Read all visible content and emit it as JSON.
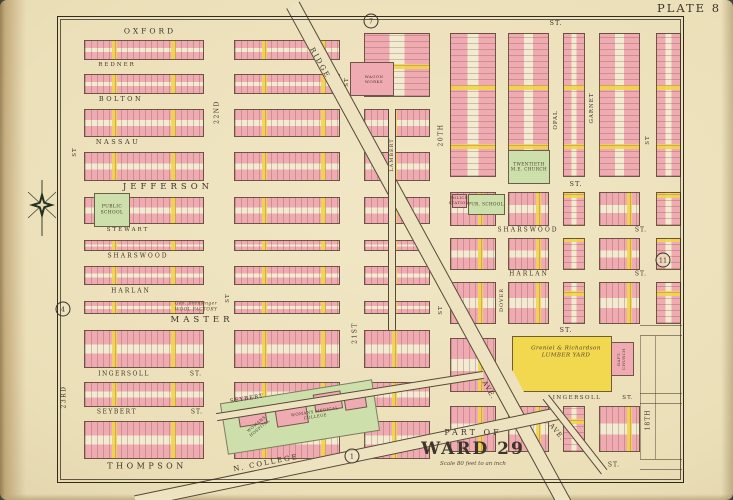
{
  "plate_label": "PLATE 8",
  "title_block": {
    "part_of": "PART OF",
    "ward": "WARD 29",
    "scale": "Scale 80 feet to an inch"
  },
  "palette": {
    "paper": "#ebdfb8",
    "block_pink": "#efabb1",
    "accent_yellow": "#f2d84e",
    "public_green": "#cde0ab",
    "line_brown": "#4a3a2c",
    "frame_black": "#332a1e"
  },
  "street_labels": [
    {
      "id": "street-oxford",
      "text": "OXFORD",
      "x": 150,
      "y": 31,
      "fs": 7.5,
      "ls": 3
    },
    {
      "id": "street-redner",
      "text": "REDNER",
      "x": 117,
      "y": 65,
      "fs": 5.5,
      "ls": 2
    },
    {
      "id": "street-bolton",
      "text": "BOLTON",
      "x": 121,
      "y": 99,
      "fs": 6.5,
      "ls": 2.5
    },
    {
      "id": "street-nassau",
      "text": "NASSAU",
      "x": 118,
      "y": 142,
      "fs": 6.5,
      "ls": 2.5
    },
    {
      "id": "street-jefferson",
      "text": "JEFFERSON",
      "x": 168,
      "y": 187,
      "fs": 8.5,
      "ls": 4
    },
    {
      "id": "street-stewart",
      "text": "STEWART",
      "x": 128,
      "y": 230,
      "fs": 5.5,
      "ls": 2
    },
    {
      "id": "street-sharswood-west",
      "text": "SHARSWOOD",
      "x": 138,
      "y": 256,
      "fs": 6,
      "ls": 2
    },
    {
      "id": "street-harlan-west",
      "text": "HARLAN",
      "x": 131,
      "y": 291,
      "fs": 6,
      "ls": 2
    },
    {
      "id": "street-master",
      "text": "MASTER",
      "x": 202,
      "y": 320,
      "fs": 8.5,
      "ls": 4
    },
    {
      "id": "street-ingersoll-west",
      "text": "INGERSOLL",
      "x": 124,
      "y": 374,
      "fs": 6,
      "ls": 1.5
    },
    {
      "id": "street-ingersoll-west-st",
      "text": "ST.",
      "x": 196,
      "y": 374,
      "fs": 6,
      "ls": 1
    },
    {
      "id": "street-seybert-west",
      "text": "SEYBERT",
      "x": 117,
      "y": 412,
      "fs": 6,
      "ls": 1.5
    },
    {
      "id": "street-seybert-west-st",
      "text": "ST.",
      "x": 197,
      "y": 412,
      "fs": 6,
      "ls": 1
    },
    {
      "id": "street-thompson",
      "text": "THOMPSON",
      "x": 147,
      "y": 466,
      "fs": 8,
      "ls": 3.5
    },
    {
      "id": "street-st-top-right",
      "text": "ST.",
      "x": 556,
      "y": 23,
      "fs": 6.5,
      "ls": 1
    },
    {
      "id": "street-st-jefferson-east",
      "text": "ST.",
      "x": 576,
      "y": 184,
      "fs": 6.5,
      "ls": 1
    },
    {
      "id": "street-sharswood-east",
      "text": "SHARSWOOD",
      "x": 528,
      "y": 230,
      "fs": 6,
      "ls": 2
    },
    {
      "id": "street-sharswood-east-st",
      "text": "ST.",
      "x": 641,
      "y": 230,
      "fs": 6,
      "ls": 1
    },
    {
      "id": "street-harlan-east",
      "text": "HARLAN",
      "x": 529,
      "y": 274,
      "fs": 6,
      "ls": 2
    },
    {
      "id": "street-harlan-east-st",
      "text": "ST.",
      "x": 641,
      "y": 274,
      "fs": 6,
      "ls": 1
    },
    {
      "id": "street-st-master-east",
      "text": "ST.",
      "x": 566,
      "y": 330,
      "fs": 6.5,
      "ls": 1
    },
    {
      "id": "street-ingersoll-east",
      "text": "INGERSOLL",
      "x": 577,
      "y": 398,
      "fs": 5.5,
      "ls": 1.5
    },
    {
      "id": "street-ingersoll-east-st",
      "text": "ST.",
      "x": 628,
      "y": 398,
      "fs": 5.5,
      "ls": 1
    },
    {
      "id": "street-st-bottom-right",
      "text": "ST.",
      "x": 614,
      "y": 465,
      "fs": 6,
      "ls": 1
    },
    {
      "id": "street-23rd",
      "text": "23RD",
      "x": 64,
      "y": 397,
      "rot": -90,
      "fs": 6,
      "ls": 1.5
    },
    {
      "id": "street-23rd-st",
      "text": "ST",
      "x": 75,
      "y": 152,
      "rot": -90,
      "fs": 5.5,
      "ls": 1
    },
    {
      "id": "street-22nd",
      "text": "22ND",
      "x": 217,
      "y": 112,
      "rot": -90,
      "fs": 6,
      "ls": 1.5
    },
    {
      "id": "street-22nd-st",
      "text": "ST",
      "x": 228,
      "y": 298,
      "rot": -90,
      "fs": 5.5,
      "ls": 1
    },
    {
      "id": "street-21st",
      "text": "21ST",
      "x": 355,
      "y": 333,
      "rot": -90,
      "fs": 6,
      "ls": 1.5
    },
    {
      "id": "street-21st-st",
      "text": "ST",
      "x": 347,
      "y": 82,
      "rot": -90,
      "fs": 5.5,
      "ls": 1
    },
    {
      "id": "street-20th",
      "text": "20TH",
      "x": 441,
      "y": 135,
      "rot": -90,
      "fs": 6,
      "ls": 1.5
    },
    {
      "id": "street-20th-st",
      "text": "ST",
      "x": 441,
      "y": 310,
      "rot": -90,
      "fs": 5.5,
      "ls": 1
    },
    {
      "id": "street-dover",
      "text": "DOVER",
      "x": 502,
      "y": 300,
      "rot": -90,
      "fs": 5,
      "ls": 1
    },
    {
      "id": "street-opal",
      "text": "OPAL",
      "x": 556,
      "y": 120,
      "rot": -90,
      "fs": 5.5,
      "ls": 1
    },
    {
      "id": "street-garnet",
      "text": "GARNET",
      "x": 592,
      "y": 108,
      "rot": -90,
      "fs": 5.5,
      "ls": 1
    },
    {
      "id": "street-18th",
      "text": "18TH",
      "x": 648,
      "y": 420,
      "rot": -90,
      "fs": 6,
      "ls": 1
    },
    {
      "id": "street-18th-st",
      "text": "ST",
      "x": 648,
      "y": 140,
      "rot": -90,
      "fs": 5.5,
      "ls": 1
    },
    {
      "id": "street-lambert",
      "text": "LAMBERT",
      "x": 392,
      "y": 155,
      "rot": -90,
      "fs": 5,
      "ls": 1
    },
    {
      "id": "street-ridge",
      "text": "RIDGE",
      "x": 320,
      "y": 63,
      "rot": 61,
      "fs": 7,
      "ls": 2
    },
    {
      "id": "street-ridge-ave-mid",
      "text": "AVE.",
      "x": 489,
      "y": 390,
      "rot": 61,
      "fs": 6.5,
      "ls": 1
    },
    {
      "id": "street-ridge-ave-lower",
      "text": "AVE.",
      "x": 557,
      "y": 432,
      "rot": 50,
      "fs": 6.5,
      "ls": 1
    },
    {
      "id": "street-n-college",
      "text": "N. COLLEGE",
      "x": 266,
      "y": 463,
      "rot": -11,
      "fs": 7,
      "ls": 2
    },
    {
      "id": "street-seybert-diagonal",
      "text": "SEYBERT",
      "x": 247,
      "y": 399,
      "rot": -9,
      "fs": 5.5,
      "ls": 1
    }
  ],
  "landmark_labels": [
    {
      "id": "label-public-school",
      "lines": [
        "PUBLIC",
        "SCHOOL"
      ],
      "x": 112,
      "y": 210,
      "fs": 4.4
    },
    {
      "id": "label-me-church",
      "lines": [
        "TWENTIETH",
        "M.E. CHURCH"
      ],
      "x": 529,
      "y": 167,
      "fs": 4.2
    },
    {
      "id": "label-police-station",
      "lines": [
        "POLICE",
        "STATION"
      ],
      "x": 459,
      "y": 201,
      "fs": 3.8
    },
    {
      "id": "label-pub-school",
      "lines": [
        "PUB. SCHOOL"
      ],
      "x": 486,
      "y": 204,
      "fs": 4.2
    },
    {
      "id": "label-lumber-yard",
      "lines": [
        "Greniel & Richardson",
        "LUMBER YARD"
      ],
      "x": 566,
      "y": 353,
      "fs": 5.6,
      "italic": true
    },
    {
      "id": "label-baptist-church",
      "lines": [
        "BAPT.",
        "CHURCH"
      ],
      "x": 621,
      "y": 359,
      "rot": -90,
      "fs": 4
    },
    {
      "id": "label-womans-medical-college",
      "lines": [
        "WOMANS MEDICAL",
        "COLLEGE"
      ],
      "x": 315,
      "y": 414,
      "rot": -9,
      "fs": 4
    },
    {
      "id": "label-womans-hospital",
      "lines": [
        "WOMANS",
        "HOSPITAL"
      ],
      "x": 258,
      "y": 426,
      "rot": -40,
      "fs": 4
    },
    {
      "id": "label-wagon-works",
      "lines": [
        "WAGON",
        "WORKS"
      ],
      "x": 374,
      "y": 79,
      "fs": 4
    },
    {
      "id": "label-wool-factory",
      "lines": [
        "Geo. Brensinger",
        "WOOL FACTORY"
      ],
      "x": 196,
      "y": 307,
      "fs": 4.4,
      "italic": true
    }
  ],
  "markers": [
    {
      "id": "marker-7",
      "text": "7",
      "x": 371,
      "y": 21
    },
    {
      "id": "marker-11",
      "text": "11",
      "x": 663,
      "y": 260
    },
    {
      "id": "marker-4",
      "text": "4",
      "x": 63,
      "y": 309
    },
    {
      "id": "marker-1",
      "text": "1",
      "x": 352,
      "y": 456
    }
  ],
  "blocks": [
    [
      84,
      40,
      120,
      20,
      "h"
    ],
    [
      84,
      74,
      120,
      20,
      "h"
    ],
    [
      84,
      109,
      120,
      28,
      "h"
    ],
    [
      84,
      152,
      120,
      29,
      "h"
    ],
    [
      84,
      197,
      120,
      27,
      "h"
    ],
    [
      84,
      240,
      120,
      11,
      "h"
    ],
    [
      84,
      266,
      120,
      19,
      "h"
    ],
    [
      84,
      301,
      120,
      13,
      "h"
    ],
    [
      84,
      330,
      120,
      38,
      "h"
    ],
    [
      84,
      382,
      120,
      25,
      "h"
    ],
    [
      84,
      421,
      120,
      38,
      "h"
    ],
    [
      234,
      40,
      106,
      20,
      "h"
    ],
    [
      234,
      74,
      106,
      20,
      "h"
    ],
    [
      234,
      109,
      106,
      28,
      "h"
    ],
    [
      234,
      152,
      106,
      29,
      "h"
    ],
    [
      234,
      197,
      106,
      27,
      "h"
    ],
    [
      234,
      240,
      106,
      11,
      "h"
    ],
    [
      234,
      266,
      106,
      19,
      "h"
    ],
    [
      234,
      301,
      106,
      13,
      "h"
    ],
    [
      234,
      330,
      106,
      38,
      "h"
    ],
    [
      234,
      382,
      106,
      25,
      "h"
    ],
    [
      234,
      421,
      106,
      38,
      "h"
    ],
    [
      364,
      33,
      66,
      64,
      "v"
    ],
    [
      364,
      109,
      66,
      28,
      "h"
    ],
    [
      364,
      152,
      66,
      29,
      "h"
    ],
    [
      364,
      197,
      66,
      27,
      "h"
    ],
    [
      364,
      240,
      66,
      11,
      "h"
    ],
    [
      364,
      266,
      66,
      19,
      "h"
    ],
    [
      364,
      301,
      66,
      13,
      "h"
    ],
    [
      364,
      330,
      66,
      38,
      "h"
    ],
    [
      364,
      382,
      66,
      25,
      "h"
    ],
    [
      364,
      421,
      66,
      38,
      "h"
    ],
    [
      350,
      62,
      44,
      34,
      "p"
    ],
    [
      450,
      33,
      46,
      144,
      "v"
    ],
    [
      450,
      192,
      46,
      34,
      "h"
    ],
    [
      450,
      238,
      46,
      32,
      "h"
    ],
    [
      450,
      282,
      46,
      42,
      "h"
    ],
    [
      450,
      338,
      46,
      54,
      "h"
    ],
    [
      450,
      406,
      46,
      46,
      "h"
    ],
    [
      508,
      33,
      41,
      144,
      "v"
    ],
    [
      508,
      192,
      41,
      34,
      "h"
    ],
    [
      508,
      238,
      41,
      32,
      "h"
    ],
    [
      508,
      282,
      41,
      42,
      "h"
    ],
    [
      508,
      406,
      41,
      46,
      "h"
    ],
    [
      563,
      33,
      22,
      144,
      "v"
    ],
    [
      563,
      192,
      22,
      34,
      "v"
    ],
    [
      563,
      238,
      22,
      32,
      "v"
    ],
    [
      563,
      282,
      22,
      42,
      "v"
    ],
    [
      563,
      406,
      22,
      46,
      "v"
    ],
    [
      599,
      33,
      41,
      144,
      "v"
    ],
    [
      599,
      192,
      41,
      34,
      "h"
    ],
    [
      599,
      238,
      41,
      32,
      "h"
    ],
    [
      599,
      282,
      41,
      42,
      "h"
    ],
    [
      599,
      406,
      41,
      46,
      "h"
    ],
    [
      656,
      33,
      25,
      144,
      "v"
    ],
    [
      656,
      192,
      25,
      34,
      "v"
    ],
    [
      656,
      238,
      25,
      32,
      "v"
    ],
    [
      656,
      282,
      25,
      42,
      "v"
    ],
    [
      94,
      193,
      36,
      34,
      "g"
    ],
    [
      468,
      194,
      37,
      21,
      "g"
    ],
    [
      508,
      150,
      42,
      34,
      "g"
    ],
    [
      452,
      194,
      15,
      14,
      "p"
    ],
    [
      608,
      342,
      26,
      34,
      "p"
    ],
    [
      512,
      336,
      100,
      56,
      "y",
      "lumber"
    ]
  ]
}
